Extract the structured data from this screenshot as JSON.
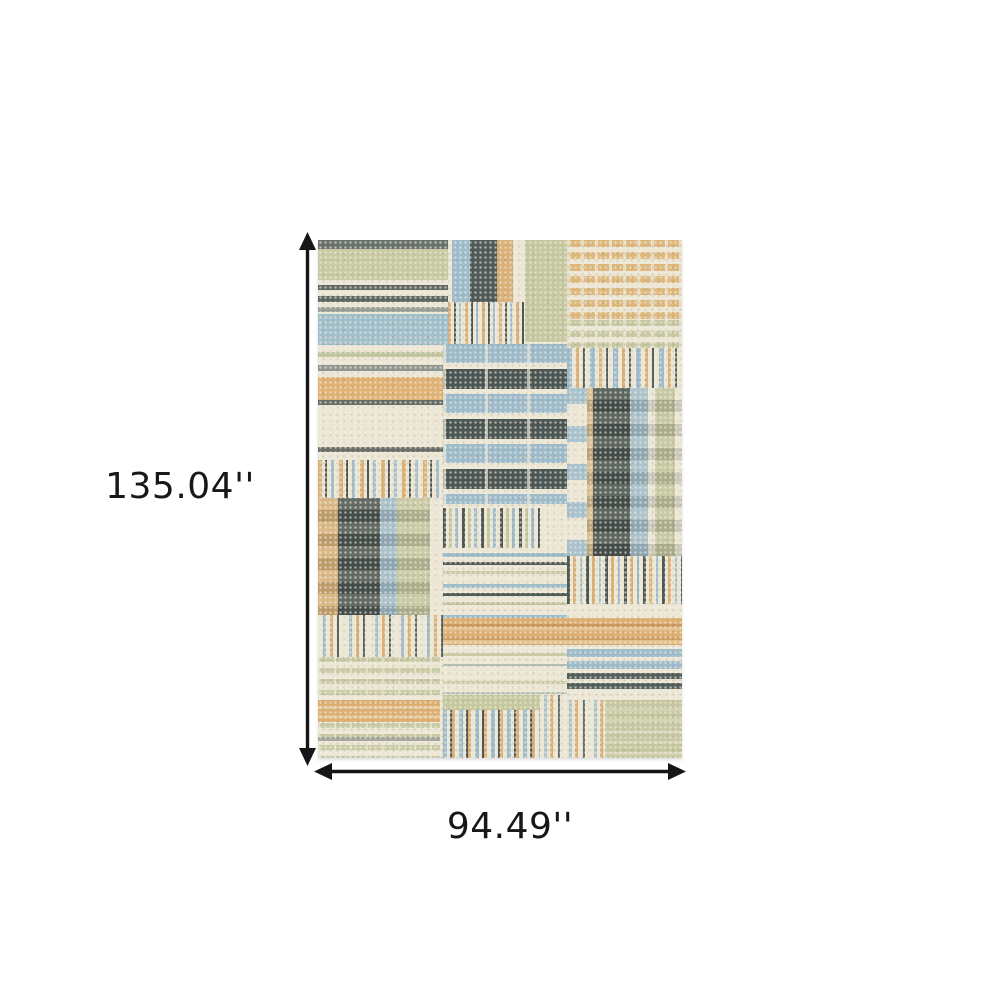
{
  "figure": {
    "background_color": "#ffffff",
    "subject": "patchwork-striped area rug"
  },
  "dimension_labels": {
    "height": "135.04''",
    "width": "94.49''"
  },
  "annotation": {
    "arrow_color": "#161616",
    "text_color": "#181818"
  },
  "icons": {
    "vertical_arrow": "double-headed-vertical-dimension-arrow",
    "horizontal_arrow": "double-headed-horizontal-dimension-arrow"
  },
  "rug_palette": {
    "cream": "#ece6d5",
    "sage_green": "#c6c8a1",
    "light_blue": "#a1becb",
    "tan_gold": "#ddb276",
    "charcoal": "#4b5553",
    "gray_green": "#68716a"
  }
}
